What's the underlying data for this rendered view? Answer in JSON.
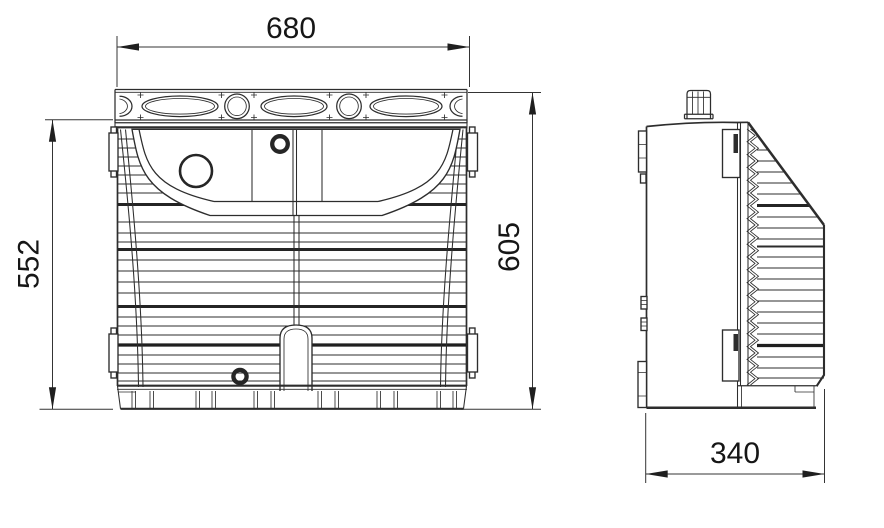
{
  "drawing": {
    "background": "#ffffff",
    "line_color": "#2d2d2d",
    "text_color": "#161616",
    "dimensions": {
      "width": "680",
      "body_height": "552",
      "overall_height": "605",
      "depth": "340"
    }
  }
}
